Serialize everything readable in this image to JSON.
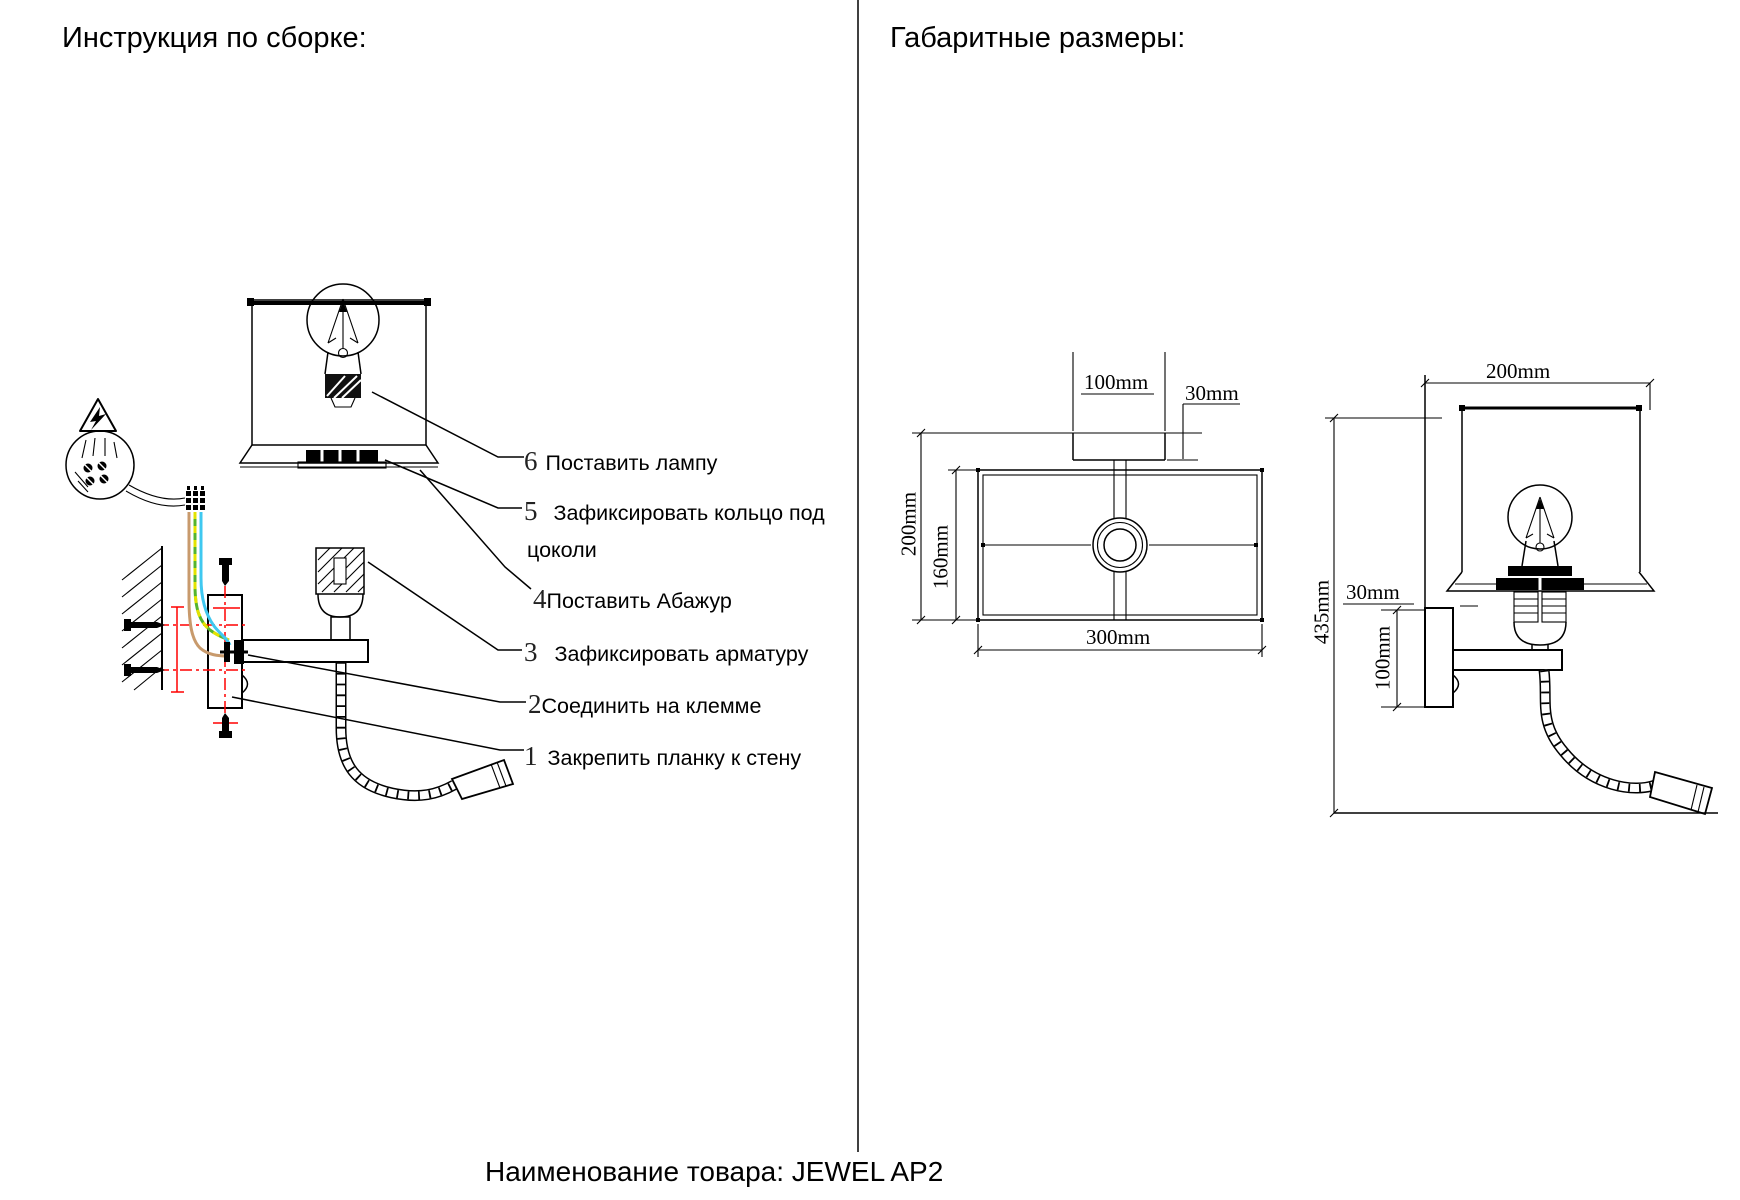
{
  "page": {
    "left_section_title": "Инструкция по сборке:",
    "right_section_title": "Габаритные размеры:",
    "product_label": "Наименование товара: JEWEL AP2"
  },
  "assembly_steps": [
    {
      "num": "1",
      "text": "Закрепить планку к стену"
    },
    {
      "num": "2",
      "text": "Соединить на клемме"
    },
    {
      "num": "3",
      "text": "Зафиксировать арматуру"
    },
    {
      "num": "4",
      "text": "Поставить Абажур"
    },
    {
      "num": "5",
      "text": "Зафиксировать кольцо под",
      "text_line2": "цоколи"
    },
    {
      "num": "6",
      "text": "Поставить лампу"
    }
  ],
  "dimensions": {
    "top_view": {
      "canopy_width": "100mm",
      "canopy_height": "30mm",
      "shade_depth": "200mm",
      "inner_depth": "160mm",
      "shade_width": "300mm"
    },
    "side_view": {
      "shade_width": "200mm",
      "overall_height": "435mm",
      "bracket_depth": "30mm",
      "backplate_height": "100mm"
    }
  },
  "colors": {
    "guide_red": "#ff0000",
    "wire_brown": "#c89a6c",
    "wire_yellow": "#e3e300",
    "wire_green": "#55b42e",
    "wire_blue": "#3fc8f0"
  }
}
